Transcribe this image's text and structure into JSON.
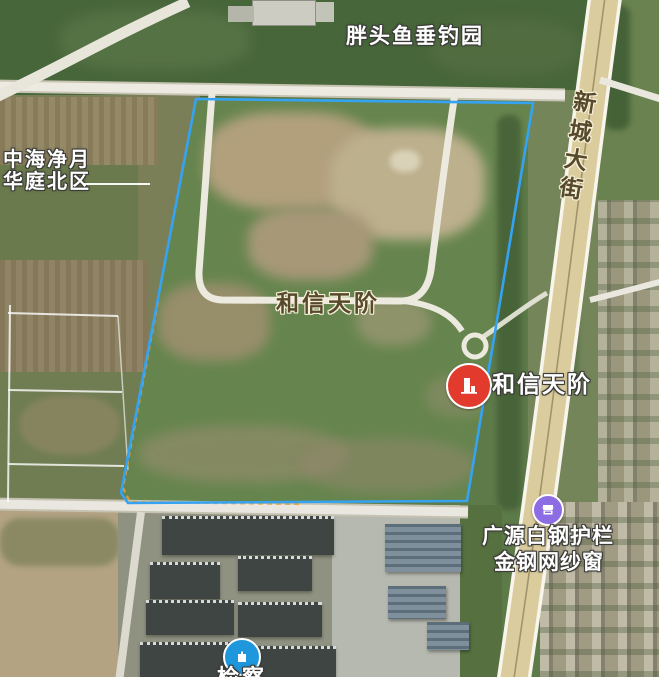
{
  "map": {
    "labels": {
      "fishing_garden": "胖头鱼垂钓园",
      "residential_line1": "中海净月",
      "residential_line2": "华庭北区",
      "site_area_label": "和信天阶",
      "site_marker_label": "和信天阶",
      "road_label": "新城大街",
      "shop_label_line1": "广源白钢护栏",
      "shop_label_line2": "金钢网纱窗",
      "bottom_partial_label": "检察"
    },
    "icons": {
      "site_marker": "building-icon",
      "shop_poi": "storefront-icon",
      "bottom_poi": "building-icon"
    },
    "colors": {
      "parcel_boundary_blue": "#35a3f2",
      "parcel_boundary_orange": "#e59f3c",
      "marker_red": "#e23a2c",
      "shop_purple": "#8d6de4",
      "poi_blue": "#1f97dc",
      "road_fill": "#dbcc9e",
      "road_edge": "#f7f5ec",
      "path_white": "#eceadf"
    }
  }
}
